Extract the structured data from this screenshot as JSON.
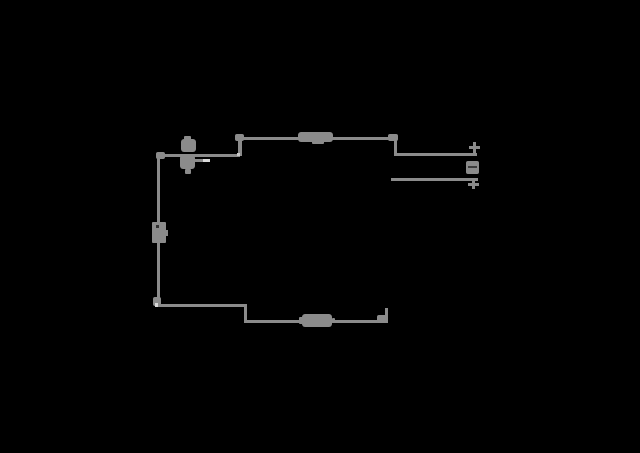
{
  "app": {
    "title": "schematic line drawing",
    "background": "#000000",
    "stroke": "#8b8b8b",
    "highlight": "#d9d9d9",
    "dark_detail": "#3c3c3c"
  },
  "drawing": {
    "canvas": {
      "width": 640,
      "height": 453
    },
    "shapes": [
      {
        "name": "top-dimension-line",
        "x": 240,
        "y": 137,
        "w": 156,
        "h": 3
      },
      {
        "name": "top-left-extension",
        "x": 238,
        "y": 138,
        "w": 4,
        "h": 18
      },
      {
        "name": "left-feed-line",
        "x": 158,
        "y": 154,
        "w": 82,
        "h": 3
      },
      {
        "name": "left-vertical-line",
        "x": 157,
        "y": 156,
        "w": 3,
        "h": 151
      },
      {
        "name": "bottom-left-line",
        "x": 157,
        "y": 304,
        "w": 90,
        "h": 3
      },
      {
        "name": "bottom-left-extension",
        "x": 244,
        "y": 305,
        "w": 3,
        "h": 17
      },
      {
        "name": "bottom-dimension-line",
        "x": 244,
        "y": 320,
        "w": 144,
        "h": 3
      },
      {
        "name": "bottom-right-extension",
        "x": 385,
        "y": 308,
        "w": 3,
        "h": 14
      },
      {
        "name": "top-right-extension",
        "x": 394,
        "y": 139,
        "w": 3,
        "h": 17
      },
      {
        "name": "right-upper-lead",
        "x": 396,
        "y": 153,
        "w": 81,
        "h": 3
      },
      {
        "name": "right-lower-lead",
        "x": 391,
        "y": 178,
        "w": 87,
        "h": 3
      },
      {
        "name": "arrowhead-top-left",
        "x": 235,
        "y": 134,
        "w": 9,
        "h": 7,
        "r": 2
      },
      {
        "name": "arrowhead-top-right",
        "x": 388,
        "y": 134,
        "w": 10,
        "h": 7,
        "r": 2
      },
      {
        "name": "arrowhead-left-top",
        "x": 156,
        "y": 152,
        "w": 9,
        "h": 7,
        "r": 2
      },
      {
        "name": "arrowhead-left-bottom",
        "x": 153,
        "y": 297,
        "w": 8,
        "h": 9,
        "r": 2
      },
      {
        "name": "arrowhead-bottom-right",
        "x": 377,
        "y": 315,
        "w": 11,
        "h": 8,
        "r": 2
      },
      {
        "name": "top-line-label-blob",
        "x": 298,
        "y": 132,
        "w": 35,
        "h": 10,
        "r": 3
      },
      {
        "name": "top-line-label-underbump",
        "x": 312,
        "y": 141,
        "w": 12,
        "h": 3,
        "r": 1
      },
      {
        "name": "bottom-line-label-blob",
        "x": 302,
        "y": 314,
        "w": 30,
        "h": 13,
        "r": 3
      },
      {
        "name": "bottom-line-label-bump-left",
        "x": 299,
        "y": 317,
        "w": 4,
        "h": 7,
        "r": 1
      },
      {
        "name": "bottom-line-label-bump-right",
        "x": 332,
        "y": 318,
        "w": 3,
        "h": 5,
        "r": 1
      },
      {
        "name": "source-symbol-cap",
        "x": 184,
        "y": 136,
        "w": 7,
        "h": 4,
        "r": 1
      },
      {
        "name": "source-symbol-upper-blob",
        "x": 181,
        "y": 139,
        "w": 15,
        "h": 13,
        "r": 3
      },
      {
        "name": "source-symbol-lower-blob",
        "x": 180,
        "y": 155,
        "w": 15,
        "h": 14,
        "r": 3
      },
      {
        "name": "source-symbol-stem",
        "x": 185,
        "y": 169,
        "w": 6,
        "h": 5,
        "r": 1
      },
      {
        "name": "source-symbol-side-stub",
        "x": 195,
        "y": 159,
        "w": 13,
        "h": 3
      },
      {
        "name": "source-symbol-highlight",
        "x": 203,
        "y": 159,
        "w": 7,
        "h": 3,
        "color": "#d9d9d9"
      },
      {
        "name": "left-vertical-label-box",
        "x": 152,
        "y": 222,
        "w": 14,
        "h": 21,
        "r": 1
      },
      {
        "name": "left-label-box-dot",
        "x": 156,
        "y": 225,
        "w": 3,
        "h": 3,
        "color": "#2f2f2f"
      },
      {
        "name": "left-label-box-tab",
        "x": 165,
        "y": 230,
        "w": 3,
        "h": 6
      },
      {
        "name": "plus-marker-upper-vbar",
        "x": 473,
        "y": 142,
        "w": 3,
        "h": 11
      },
      {
        "name": "plus-marker-upper-hbar",
        "x": 469,
        "y": 146,
        "w": 11,
        "h": 3
      },
      {
        "name": "mid-voltage-label-blob",
        "x": 466,
        "y": 161,
        "w": 13,
        "h": 13,
        "r": 2
      },
      {
        "name": "mid-voltage-label-gap",
        "x": 468,
        "y": 166,
        "w": 9,
        "h": 2,
        "color": "#3c3c3c"
      },
      {
        "name": "cross-marker-lower-vbar",
        "x": 472,
        "y": 179,
        "w": 3,
        "h": 10
      },
      {
        "name": "cross-marker-lower-hbar",
        "x": 468,
        "y": 183,
        "w": 11,
        "h": 3
      },
      {
        "name": "junction-speck-left-bottom",
        "x": 155,
        "y": 303,
        "w": 3,
        "h": 4,
        "color": "#d9d9d9"
      },
      {
        "name": "junction-speck-top-left",
        "x": 237,
        "y": 153,
        "w": 3,
        "h": 3,
        "color": "#c9c9c9"
      }
    ]
  }
}
